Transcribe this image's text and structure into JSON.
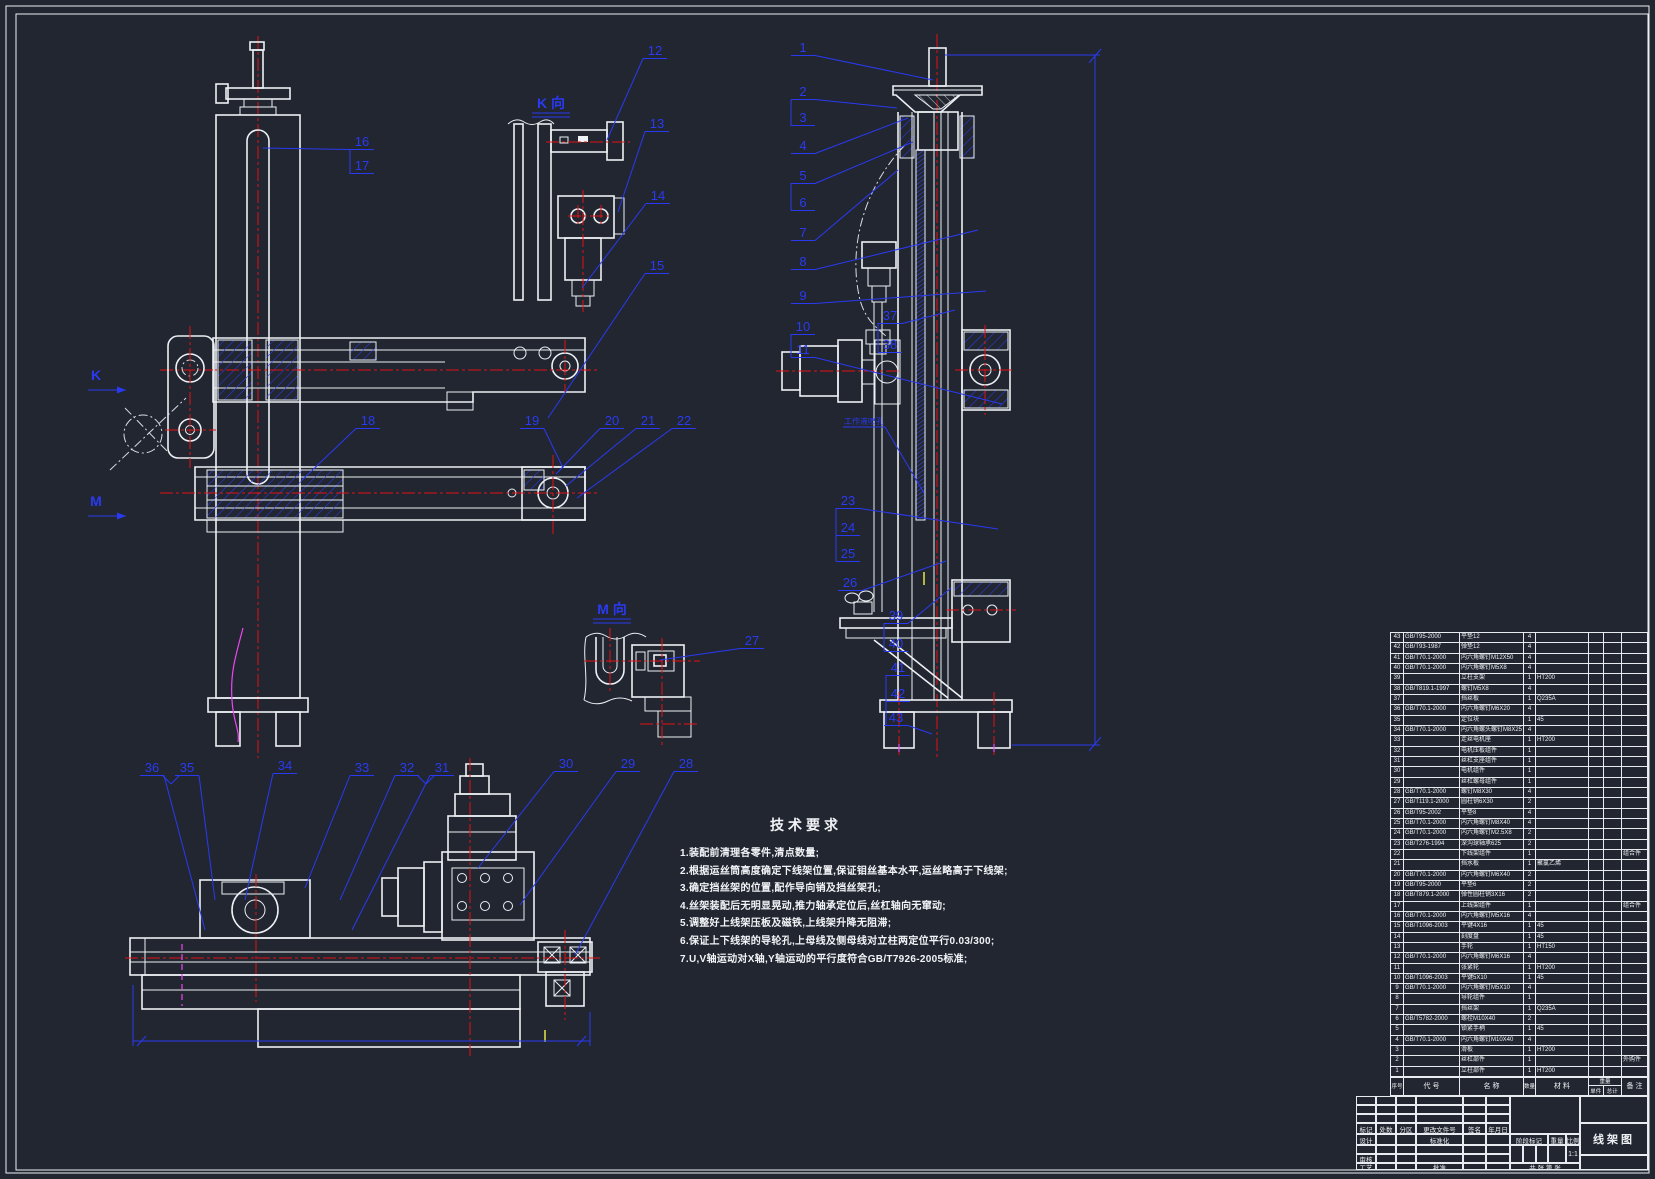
{
  "colors": {
    "background": "#212630",
    "line_white": "#edf0f4",
    "callout_blue": "#2a3af2",
    "centerline_red": "#e31313",
    "accent_magenta": "#ef46ef",
    "accent_yellow": "#e6e645"
  },
  "tech_requirements": {
    "title": "技术要求",
    "items": [
      "1.装配前清理各零件,清点数量;",
      "2.根据运丝筒高度确定下线架位置,保证钼丝基本水平,运丝略高于下线架;",
      "3.确定挡丝架的位置,配作导向销及挡丝架孔;",
      "4.丝架装配后无明显晃动,推力轴承定位后,丝杠轴向无窜动;",
      "5.调整好上线架压板及磁铁,上线架升降无阻滞;",
      "6.保证上下线架的导轮孔,上母线及侧母线对立柱两定位平行0.03/300;",
      "7.U,V轴运动对X轴,Y轴运动的平行度符合GB/T7926-2005标准;"
    ]
  },
  "drawing": {
    "overlay_labels": [
      {
        "t": "K 向",
        "x": 551,
        "y": 108,
        "kind": "view"
      },
      {
        "t": "M 向",
        "x": 612,
        "y": 614,
        "kind": "view"
      },
      {
        "t": "K",
        "x": 96,
        "y": 380,
        "kind": "arrow"
      },
      {
        "t": "M",
        "x": 96,
        "y": 506,
        "kind": "arrow"
      },
      {
        "t": "工作液喷孔",
        "x": 864,
        "y": 424,
        "kind": "note",
        "ex": 924,
        "ey": 493
      }
    ],
    "callouts": [
      {
        "t": "1",
        "x": 803,
        "y": 52,
        "ex": 933,
        "ey": 80
      },
      {
        "t": "2",
        "x": 803,
        "y": 96,
        "ex": 897,
        "ey": 108
      },
      {
        "t": "3",
        "x": 803,
        "y": 122
      },
      {
        "t": "4",
        "x": 803,
        "y": 150,
        "ex": 908,
        "ey": 118
      },
      {
        "t": "5",
        "x": 803,
        "y": 180,
        "ex": 913,
        "ey": 142
      },
      {
        "t": "6",
        "x": 803,
        "y": 207
      },
      {
        "t": "7",
        "x": 803,
        "y": 237,
        "ex": 898,
        "ey": 170
      },
      {
        "t": "8",
        "x": 803,
        "y": 266,
        "ex": 978,
        "ey": 230
      },
      {
        "t": "9",
        "x": 803,
        "y": 300,
        "ex": 986,
        "ey": 291
      },
      {
        "t": "10",
        "x": 803,
        "y": 331
      },
      {
        "t": "11",
        "x": 803,
        "y": 354,
        "ex": 1002,
        "ey": 404
      },
      {
        "t": "37",
        "x": 890,
        "y": 320,
        "ex": 955,
        "ey": 310
      },
      {
        "t": "38",
        "x": 890,
        "y": 349
      },
      {
        "t": "23",
        "x": 848,
        "y": 505,
        "ex": 998,
        "ey": 529
      },
      {
        "t": "24",
        "x": 848,
        "y": 532
      },
      {
        "t": "25",
        "x": 848,
        "y": 558
      },
      {
        "t": "26",
        "x": 850,
        "y": 587,
        "ex": 946,
        "ey": 561
      },
      {
        "t": "39",
        "x": 896,
        "y": 620,
        "ex": 951,
        "ey": 588
      },
      {
        "t": "40",
        "x": 896,
        "y": 648
      },
      {
        "t": "41",
        "x": 898,
        "y": 672
      },
      {
        "t": "42",
        "x": 898,
        "y": 698
      },
      {
        "t": "43",
        "x": 896,
        "y": 722,
        "ex": 932,
        "ey": 734
      },
      {
        "t": "12",
        "x": 655,
        "y": 55,
        "ex": 607,
        "ey": 140
      },
      {
        "t": "13",
        "x": 657,
        "y": 128,
        "ex": 618,
        "ey": 212
      },
      {
        "t": "14",
        "x": 658,
        "y": 200,
        "ex": 582,
        "ey": 288
      },
      {
        "t": "15",
        "x": 657,
        "y": 270,
        "ex": 548,
        "ey": 418
      },
      {
        "t": "16",
        "x": 362,
        "y": 146,
        "ex": 263,
        "ey": 148
      },
      {
        "t": "17",
        "x": 362,
        "y": 170
      },
      {
        "t": "18",
        "x": 368,
        "y": 425,
        "ex": 302,
        "ey": 480
      },
      {
        "t": "19",
        "x": 532,
        "y": 425,
        "ex": 563,
        "ey": 468
      },
      {
        "t": "20",
        "x": 612,
        "y": 425,
        "ex": 556,
        "ey": 474
      },
      {
        "t": "21",
        "x": 648,
        "y": 425,
        "ex": 566,
        "ey": 486
      },
      {
        "t": "22",
        "x": 684,
        "y": 425,
        "ex": 577,
        "ey": 498
      },
      {
        "t": "27",
        "x": 752,
        "y": 645,
        "ex": 660,
        "ey": 660
      },
      {
        "t": "36",
        "x": 152,
        "y": 772,
        "ex": 205,
        "ey": 930
      },
      {
        "t": "35",
        "x": 187,
        "y": 772,
        "ex": 215,
        "ey": 900
      },
      {
        "t": "34",
        "x": 285,
        "y": 770,
        "ex": 245,
        "ey": 900
      },
      {
        "t": "33",
        "x": 362,
        "y": 772,
        "ex": 305,
        "ey": 888
      },
      {
        "t": "32",
        "x": 407,
        "y": 772,
        "ex": 340,
        "ey": 900
      },
      {
        "t": "31",
        "x": 442,
        "y": 772,
        "ex": 352,
        "ey": 930
      },
      {
        "t": "30",
        "x": 566,
        "y": 768,
        "ex": 478,
        "ey": 868
      },
      {
        "t": "29",
        "x": 628,
        "y": 768,
        "ex": 520,
        "ey": 905
      },
      {
        "t": "28",
        "x": 686,
        "y": 768,
        "ex": 575,
        "ey": 955
      }
    ],
    "blue_lines": [
      [
        350,
        150,
        350,
        174
      ],
      [
        791,
        100,
        791,
        126
      ],
      [
        791,
        183,
        791,
        210
      ],
      [
        791,
        334,
        791,
        357
      ],
      [
        878,
        323,
        878,
        352
      ],
      [
        836,
        508,
        836,
        561
      ],
      [
        884,
        623,
        884,
        651
      ],
      [
        886,
        675,
        886,
        725
      ],
      [
        1095,
        55,
        1095,
        745
      ],
      [
        945,
        55,
        1100,
        55
      ],
      [
        1012,
        745,
        1100,
        745
      ],
      [
        163,
        776,
        171,
        784
      ],
      [
        171,
        784,
        179,
        776
      ],
      [
        418,
        776,
        426,
        784
      ],
      [
        426,
        784,
        434,
        776
      ],
      [
        133,
        985,
        133,
        1046
      ],
      [
        590,
        1012,
        590,
        1046
      ],
      [
        133,
        1041,
        590,
        1041
      ],
      [
        1089,
        63,
        1101,
        49
      ],
      [
        1089,
        751,
        1101,
        737
      ],
      [
        137,
        1046,
        146,
        1036
      ],
      [
        577,
        1046,
        586,
        1036
      ]
    ]
  },
  "bom": {
    "header": {
      "seq": "序号",
      "code": "代 号",
      "name": "名 称",
      "qty": "数量",
      "material": "材 料",
      "weight": "重量",
      "unit": "单件",
      "total": "总计",
      "remark": "备 注"
    },
    "rows": [
      [
        "43",
        "GB/T95-2000",
        "平垫12",
        "4",
        "",
        "",
        "",
        ""
      ],
      [
        "42",
        "GB/T93-1987",
        "弹垫12",
        "4",
        "",
        "",
        "",
        ""
      ],
      [
        "41",
        "GB/T70.1-2000",
        "内六角螺钉M12X50",
        "4",
        "",
        "",
        "",
        ""
      ],
      [
        "40",
        "GB/T70.1-2000",
        "内六角螺钉M5X8",
        "4",
        "",
        "",
        "",
        ""
      ],
      [
        "39",
        "",
        "立柱支架",
        "1",
        "HT200",
        "",
        "",
        ""
      ],
      [
        "38",
        "GB/T819.1-1997",
        "螺钉M5X8",
        "4",
        "",
        "",
        "",
        ""
      ],
      [
        "37",
        "",
        "挡丝板",
        "1",
        "Q235A",
        "",
        "",
        ""
      ],
      [
        "36",
        "GB/T70.1-2000",
        "内六角螺钉M6X20",
        "4",
        "",
        "",
        "",
        ""
      ],
      [
        "35",
        "",
        "定位块",
        "1",
        "45",
        "",
        "",
        ""
      ],
      [
        "34",
        "GB/T70.1-2000",
        "内六角螺头螺钉M8X25",
        "4",
        "",
        "",
        "",
        ""
      ],
      [
        "33",
        "",
        "走丝电机座",
        "1",
        "HT200",
        "",
        "",
        ""
      ],
      [
        "32",
        "",
        "电机压板组件",
        "1",
        "",
        "",
        "",
        ""
      ],
      [
        "31",
        "",
        "丝杠支座组件",
        "1",
        "",
        "",
        "",
        ""
      ],
      [
        "30",
        "",
        "电机组件",
        "1",
        "",
        "",
        "",
        ""
      ],
      [
        "29",
        "",
        "丝杠螺母组件",
        "1",
        "",
        "",
        "",
        ""
      ],
      [
        "28",
        "GB/T70.1-2000",
        "螺钉M8X30",
        "4",
        "",
        "",
        "",
        ""
      ],
      [
        "27",
        "GB/T119.1-2000",
        "圆柱销6X30",
        "2",
        "",
        "",
        "",
        ""
      ],
      [
        "26",
        "GB/T95-2002",
        "平垫8",
        "4",
        "",
        "",
        "",
        ""
      ],
      [
        "25",
        "GB/T70.1-2000",
        "内六角螺钉M8X40",
        "4",
        "",
        "",
        "",
        ""
      ],
      [
        "24",
        "GB/T70.1-2000",
        "内六角螺钉M2.5X8",
        "2",
        "",
        "",
        "",
        ""
      ],
      [
        "23",
        "GB/T276-1994",
        "深沟球轴承625",
        "2",
        "",
        "",
        "",
        ""
      ],
      [
        "22",
        "",
        "下线架组件",
        "1",
        "",
        "",
        "",
        "组合件"
      ],
      [
        "21",
        "",
        "挡水板",
        "1",
        "聚氯乙烯",
        "",
        "",
        ""
      ],
      [
        "20",
        "GB/T70.1-2000",
        "内六角螺钉M6X40",
        "2",
        "",
        "",
        "",
        ""
      ],
      [
        "19",
        "GB/T95-2000",
        "平垫6",
        "2",
        "",
        "",
        "",
        ""
      ],
      [
        "18",
        "GB/T879.1-2000",
        "弹性圆柱销3X16",
        "2",
        "",
        "",
        "",
        ""
      ],
      [
        "17",
        "",
        "上线架组件",
        "1",
        "",
        "",
        "",
        "组合件"
      ],
      [
        "16",
        "GB/T70.1-2000",
        "内六角螺钉M5X16",
        "4",
        "",
        "",
        "",
        ""
      ],
      [
        "15",
        "GB/T1096-2003",
        "平键4X16",
        "1",
        "45",
        "",
        "",
        ""
      ],
      [
        "14",
        "",
        "刻度盘",
        "1",
        "45",
        "",
        "",
        ""
      ],
      [
        "13",
        "",
        "手轮",
        "1",
        "HT150",
        "",
        "",
        ""
      ],
      [
        "12",
        "GB/T70.1-2000",
        "内六角螺钉M6X16",
        "4",
        "",
        "",
        "",
        ""
      ],
      [
        "11",
        "",
        "张紧轮",
        "1",
        "HT200",
        "",
        "",
        ""
      ],
      [
        "10",
        "GB/T1096-2003",
        "平键5X10",
        "1",
        "45",
        "",
        "",
        ""
      ],
      [
        "9",
        "GB/T70.1-2000",
        "内六角螺钉M5X10",
        "4",
        "",
        "",
        "",
        ""
      ],
      [
        "8",
        "",
        "导轮组件",
        "1",
        "",
        "",
        "",
        ""
      ],
      [
        "7",
        "",
        "挡丝架",
        "1",
        "Q235A",
        "",
        "",
        ""
      ],
      [
        "6",
        "GB/T5782-2000",
        "螺栓M10X40",
        "2",
        "",
        "",
        "",
        ""
      ],
      [
        "5",
        "",
        "锁紧手柄",
        "1",
        "45",
        "",
        "",
        ""
      ],
      [
        "4",
        "GB/T70.1-2000",
        "内六角螺钉M10X40",
        "4",
        "",
        "",
        "",
        ""
      ],
      [
        "3",
        "",
        "滑板",
        "1",
        "HT200",
        "",
        "",
        ""
      ],
      [
        "2",
        "",
        "丝杠部件",
        "1",
        "",
        "",
        "",
        "外购件"
      ],
      [
        "1",
        "",
        "立柱部件",
        "1",
        "HT200",
        "",
        "",
        ""
      ]
    ]
  },
  "title_block": {
    "mark": "标记",
    "count": "处数",
    "zone": "分区",
    "change_doc": "更改文件号",
    "sign": "签名",
    "date": "年月日",
    "design": "设计",
    "standard": "标准化",
    "check": "审核",
    "process": "工艺",
    "approve": "批准",
    "stage_mark": "阶段标记",
    "weight": "重量",
    "scale": "比例",
    "scale_value": "1:1",
    "sheets": "共 张 第 张",
    "title": "线架图"
  }
}
